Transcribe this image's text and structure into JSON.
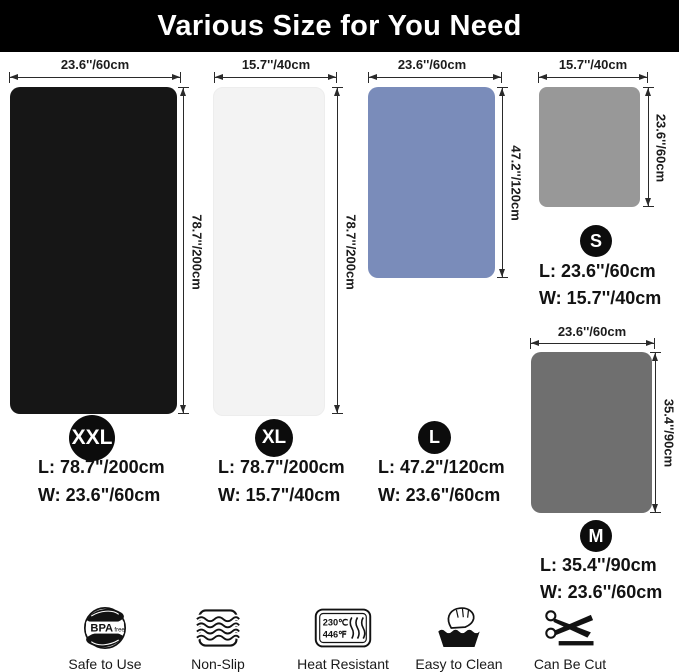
{
  "title": "Various Size for You Need",
  "mats": {
    "xxl": {
      "badge": "XXL",
      "color": "#161616",
      "top_label": "23.6''/60cm",
      "side_label": "78.7''/200cm",
      "length_line": "L: 78.7\"/200cm",
      "width_line": "W: 23.6\"/60cm"
    },
    "xl": {
      "badge": "XL",
      "color": "#f3f3f3",
      "top_label": "15.7''/40cm",
      "side_label": "78.7''/200cm",
      "length_line": "L: 78.7\"/200cm",
      "width_line": "W: 15.7\"/40cm"
    },
    "l": {
      "badge": "L",
      "color": "#7a8cba",
      "top_label": "23.6''/60cm",
      "side_label": "47.2''/120cm",
      "length_line": "L: 47.2\"/120cm",
      "width_line": "W: 23.6\"/60cm"
    },
    "s": {
      "badge": "S",
      "color": "#989898",
      "top_label": "15.7''/40cm",
      "side_label": "23.6''/60cm",
      "length_line": "L: 23.6''/60cm",
      "width_line": "W: 15.7''/40cm"
    },
    "m": {
      "badge": "M",
      "color": "#6f6f6f",
      "top_label": "23.6''/60cm",
      "side_label": "35.4''/90cm",
      "length_line": "L: 35.4''/90cm",
      "width_line": "W: 23.6''/60cm"
    }
  },
  "features": [
    {
      "icon": "bpa-free-icon",
      "label": "Safe to Use",
      "badge_text": "BPA",
      "badge_sub": "free"
    },
    {
      "icon": "non-slip-icon",
      "label": "Non-Slip"
    },
    {
      "icon": "heat-resistant-icon",
      "label": "Heat Resistant",
      "temp_c": "230℃",
      "temp_f": "446℉"
    },
    {
      "icon": "easy-to-clean-icon",
      "label": "Easy to Clean"
    },
    {
      "icon": "can-be-cut-icon",
      "label": "Can Be Cut"
    }
  ]
}
